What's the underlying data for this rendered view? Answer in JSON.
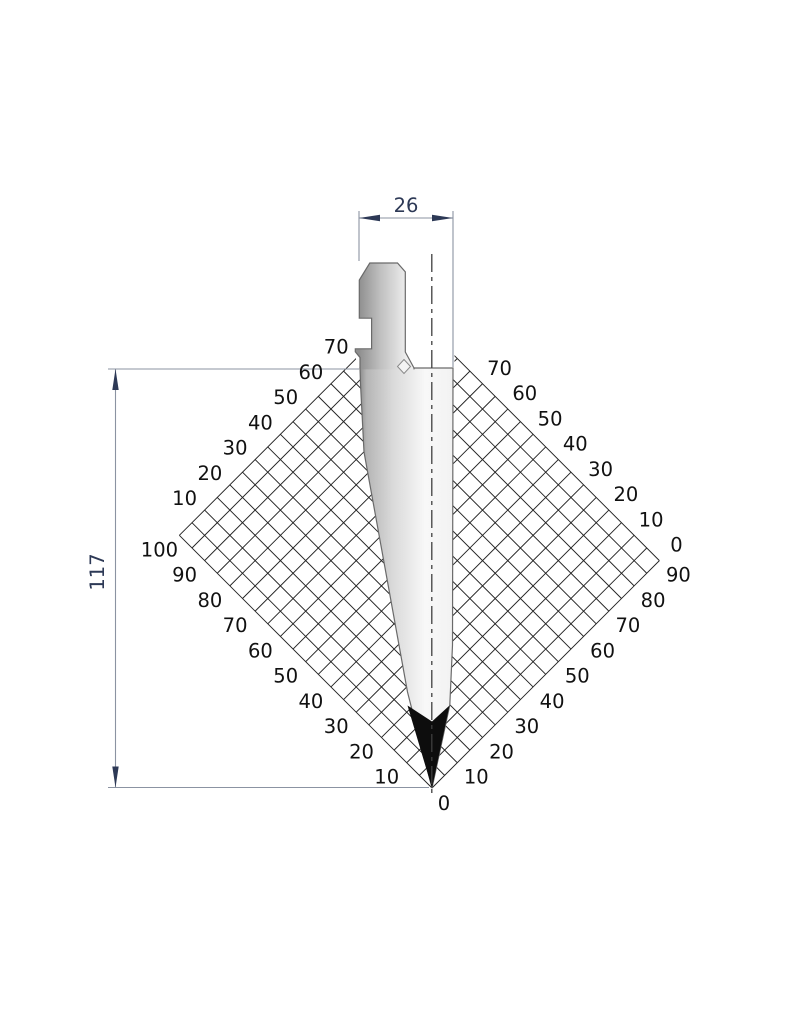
{
  "drawing": {
    "dimension_width": "26",
    "dimension_height": "117",
    "origin_label": "0"
  },
  "scales": {
    "upper_left": [
      10,
      20,
      30,
      40,
      50,
      60,
      70
    ],
    "lower_left": [
      10,
      20,
      30,
      40,
      50,
      60,
      70,
      80,
      90,
      100
    ],
    "lower_right": [
      10,
      20,
      30,
      40,
      50,
      60,
      70,
      80,
      90
    ],
    "upper_right": [
      0,
      10,
      20,
      30,
      40,
      50,
      60,
      70
    ]
  },
  "grid": {
    "cell_units": 5,
    "lower_left_extent": 100,
    "lower_right_extent": 90
  },
  "colors": {
    "background": "#ffffff",
    "grid_line": "#232323",
    "tool_outline": "#6a6a6a",
    "tip_fill": "#0d0d0d",
    "dimension_line": "#8b93a2",
    "dimension_text": "#2d3956",
    "scale_text": "#111111",
    "center_line": "#3f3f3f"
  }
}
